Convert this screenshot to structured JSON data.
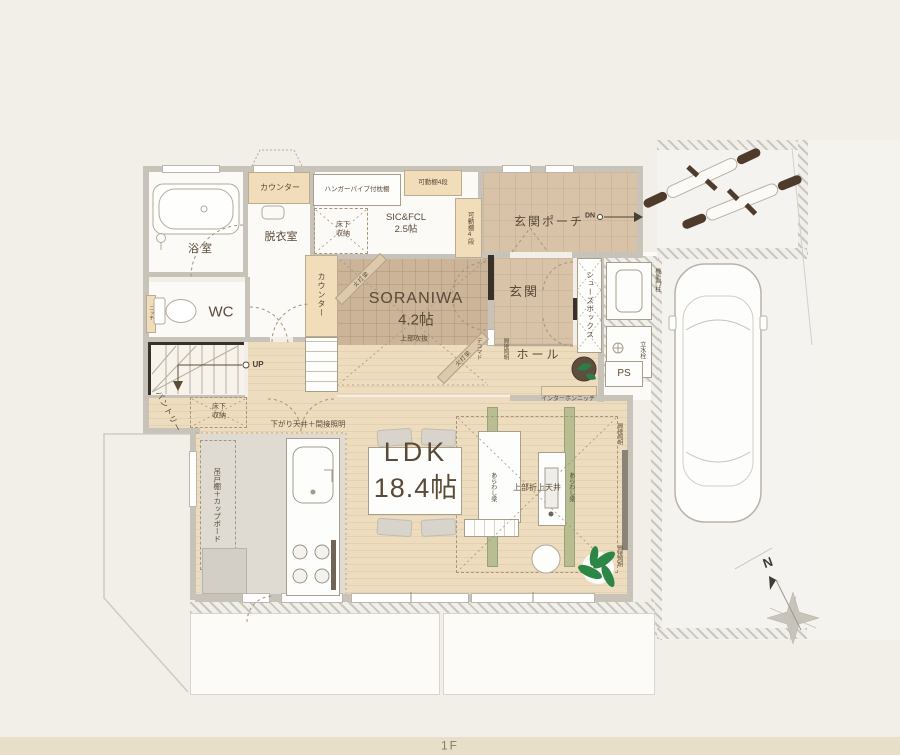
{
  "floor": {
    "label": "1F"
  },
  "compass": {
    "north": "N"
  },
  "rooms": {
    "bath": "浴室",
    "dressing": "脱衣室",
    "wc": "WC",
    "sic": "SIC&FCL\n2.5帖",
    "porch": "玄関ポーチ",
    "entrance": "玄関",
    "soraniwa_name": "SORANIWA",
    "soraniwa_size": "4.2帖",
    "soraniwa_note": "上部吹抜",
    "hall": "ホール",
    "ldk_name": "LDK",
    "ldk_size": "18.4帖",
    "pantry": "パントリー",
    "ps": "PS"
  },
  "annotations": {
    "counter_top": "カウンター",
    "counter_side": "カウンター",
    "hanger_shelf": "ハンガーパイプ付枕棚",
    "movable_shelf_top": "可動棚4段",
    "movable_shelf_side": "可動棚4段",
    "underfloor_storage_sic": "床下収納",
    "underfloor_storage_pantry": "床下収納",
    "shoes_box": "シューズボックス",
    "gate_post": "機能門柱",
    "water_tap": "立水栓",
    "intercom_niche": "インターホンニッチ",
    "niche": "ニッチ",
    "deco_window": "デコマド",
    "indirect_light_entrance": "間接照明",
    "indirect_light_ldk_top": "間接照明",
    "indirect_light_ldk_bottom": "間接照明",
    "lowered_ceiling": "下がり天井＋間接照明",
    "hanging_cupboard": "吊戸棚＋カップボード",
    "exposed_beam_left": "あらわし梁",
    "exposed_beam_right": "あらわし梁",
    "coffered_ceiling": "上部折上天井",
    "corner_beam_upper": "火打梁",
    "corner_beam_lower": "火打梁",
    "down": "DN",
    "up": "UP"
  },
  "colors": {
    "background": "#f2efe8",
    "wood_floor": "#e9d6b4",
    "tatami_floor": "#ccb499",
    "porch_floor": "#d8c3a8",
    "accent_beige": "#f2ddba",
    "beam_green": "#b9bd92",
    "wall_gray": "#c8c3b9",
    "text_brown": "#5a4a38",
    "bottom_bar": "#e8dfcb"
  }
}
